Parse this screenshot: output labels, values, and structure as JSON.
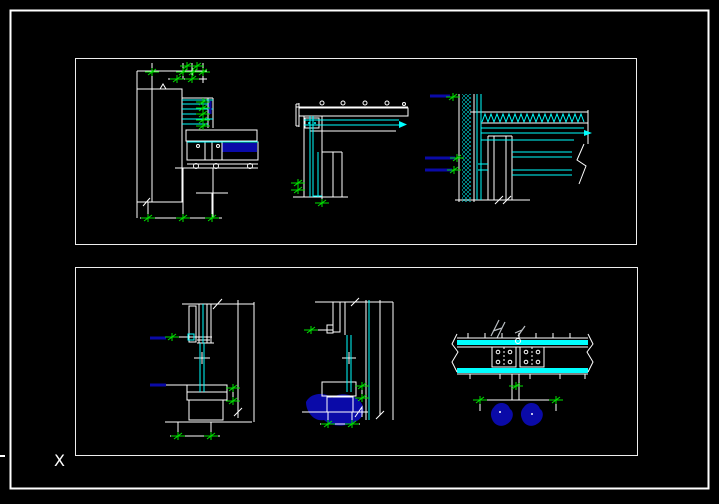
{
  "ucs": {
    "x_axis_label": "X"
  },
  "colors": {
    "line_cyan": "#00ffff",
    "line_white": "#ffffff",
    "dim_green": "#00e000",
    "leader_blue": "#0a0aa8",
    "annotation_gray": "#b9bdc2"
  },
  "panels": {
    "top": {
      "name": "top-details-panel"
    },
    "bottom": {
      "name": "bottom-details-panel"
    }
  },
  "drawings": [
    {
      "id": "detail-wall-soffit-section"
    },
    {
      "id": "detail-ceiling-edge-section"
    },
    {
      "id": "detail-parapet-roof-edge-section"
    },
    {
      "id": "detail-window-sill-section-a"
    },
    {
      "id": "detail-window-sill-section-b"
    },
    {
      "id": "detail-mullion-splice-plan"
    }
  ]
}
